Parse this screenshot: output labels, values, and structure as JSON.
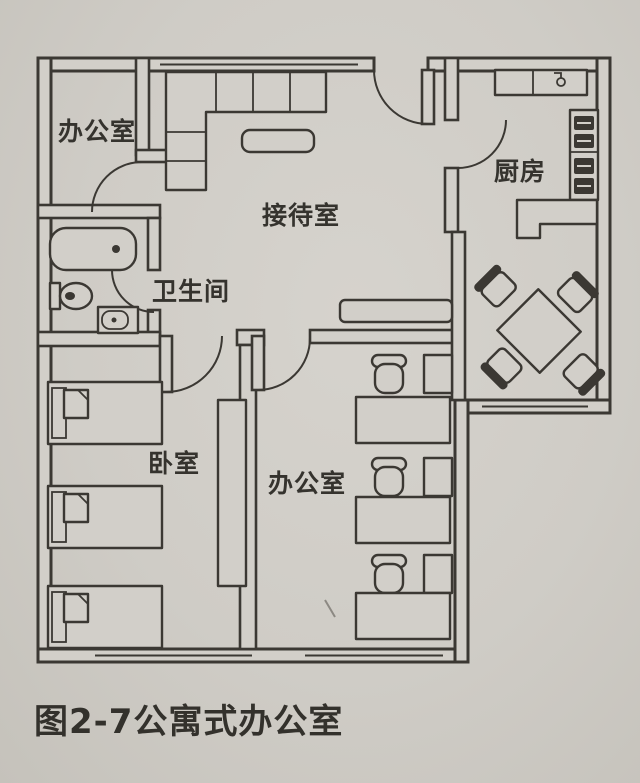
{
  "figure": {
    "caption": "图2-7公寓式办公室"
  },
  "rooms": {
    "office_top_left": "办公室",
    "reception": "接待室",
    "kitchen": "厨房",
    "bathroom": "卫生间",
    "bedroom": "卧室",
    "office_bottom": "办公室"
  },
  "colors": {
    "paper": "#d2cfc9",
    "ink": "#3b3833"
  }
}
